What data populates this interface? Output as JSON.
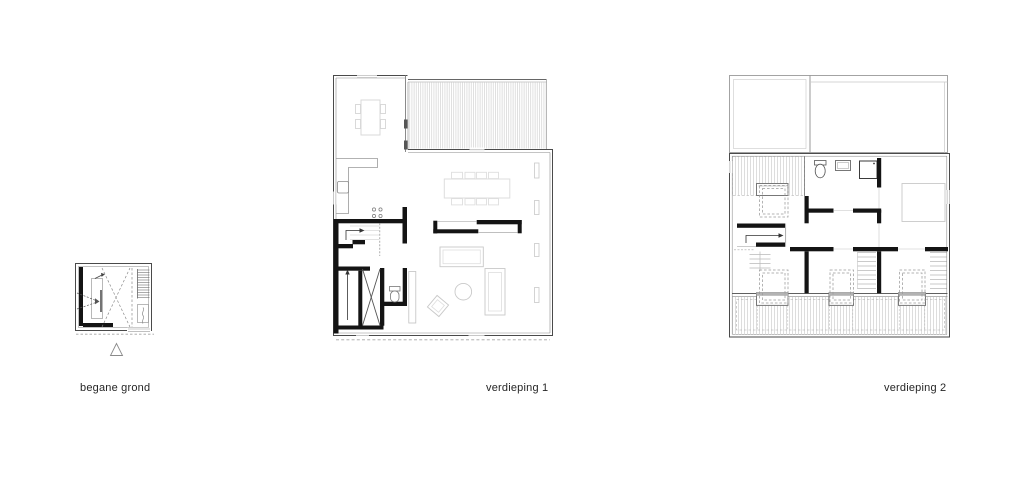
{
  "plans": [
    {
      "id": "begane-grond",
      "label": "begane grond"
    },
    {
      "id": "verdieping-1",
      "label": "verdieping 1"
    },
    {
      "id": "verdieping-2",
      "label": "verdieping 2"
    }
  ],
  "symbols": {
    "north_marker": "triangle-outline"
  },
  "palette": {
    "background": "#ffffff",
    "wall_dark": "#141414",
    "wall_outline": "#4a4a4a",
    "wall_light": "#8a8a8a",
    "furniture": "#c9c9c9",
    "furniture_light": "#dedede",
    "hatch": "#c9c9c9",
    "dash": "#9a9a9a",
    "label_text": "#262626"
  }
}
